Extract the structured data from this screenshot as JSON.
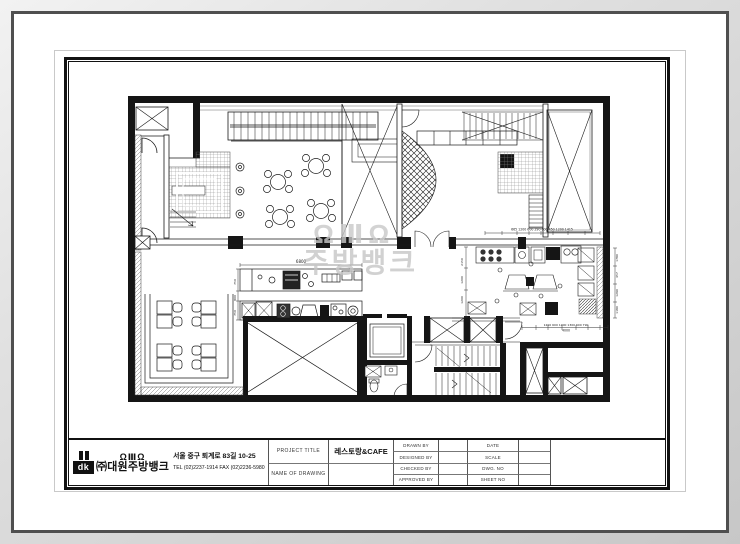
{
  "watermark": {
    "logo": "ΩⅢΩ",
    "text": "주방뱅크"
  },
  "title_block": {
    "company": {
      "logo_text": "dk",
      "brand_marks": "ΩⅢΩ",
      "name": "㈜대원주방뱅크",
      "address": "서울 중구 퇴계로 83길 10-25",
      "tel": "TEL (02)2237-1914 FAX (02)2236-5980"
    },
    "project_title_label": "PROJECT TITLE",
    "project_title": "레스토랑&CAFE",
    "name_of_drawing_label": "NAME OF DRAWING",
    "name_of_drawing": "",
    "people": [
      {
        "label": "DRAWN BY",
        "value": ""
      },
      {
        "label": "DESIGNED BY",
        "value": ""
      },
      {
        "label": "CHECKED BY",
        "value": ""
      },
      {
        "label": "APPROVED BY",
        "value": ""
      }
    ],
    "meta": [
      {
        "label": "DATE",
        "value": ""
      },
      {
        "label": "SCALE",
        "value": ""
      },
      {
        "label": "DWG. NO",
        "value": ""
      },
      {
        "label": "SHEET NO",
        "value": ""
      }
    ]
  },
  "plan": {
    "dims": {
      "counter_top": "6800",
      "counter_left": [
        "750",
        "800",
        "750"
      ],
      "top_right_row": "665  1200  600 290 600 450  1200  1415",
      "kitchen_left": [
        "2150",
        "1200",
        "1200"
      ],
      "kitchen_row": "1200 600 1000 1300 600 790",
      "kitchen_total": "4000",
      "right_col": [
        "1780",
        "457",
        "1290",
        "1180"
      ]
    }
  }
}
